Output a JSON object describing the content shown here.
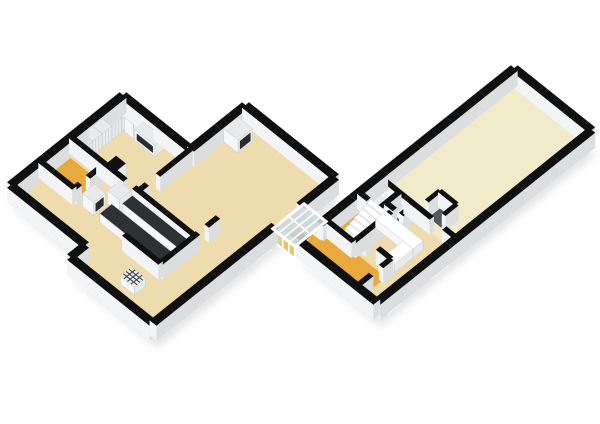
{
  "scene": {
    "type": "isometric-floorplan-3d-render",
    "background": "#FFFFFF",
    "wings": [
      "left-apartment-wing",
      "glass-connector-corridor",
      "right-apartment-wing"
    ]
  },
  "colors": {
    "background": "#FFFFFF",
    "wall_top": "#101010",
    "wall_face_light": "#F3F4F5",
    "wall_face_shade": "#DBDDDF",
    "wall_face_dark": "#C9CCCF",
    "floor_beige": "#EEDBAE",
    "floor_cream": "#F2EBCA",
    "floor_orange": "#E9A93D",
    "floor_dark": "#55585C",
    "window_glass": "#CBD6DD",
    "glass_amber": "#EBC878",
    "frame_white": "#FFFFFF",
    "counter_top_dark": "#2E3134",
    "furniture_top": "#E9EAEC",
    "furniture_face": "#F6F7F8",
    "furniture_stroke": "#C9CCCF",
    "decor_dark": "#2A2C2E",
    "shadow": "rgba(0,0,0,0.10)"
  },
  "floorplan": {
    "projection": {
      "origin": [
        123,
        110
      ],
      "kx": 12.5,
      "ky": 10,
      "wall_height_px": 15
    },
    "floors": [
      {
        "name": "left-wing-floor-beige",
        "color": "floor_beige",
        "pts": [
          [
            0,
            0
          ],
          [
            5.4,
            0
          ],
          [
            5.4,
            -4.4
          ],
          [
            12.6,
            -4.4
          ],
          [
            12.6,
            10.2
          ],
          [
            6.0,
            10.2
          ],
          [
            6.0,
            9.0
          ],
          [
            0,
            9.0
          ]
        ]
      },
      {
        "name": "bathroom-floor-orange",
        "color": "floor_orange",
        "pts": [
          [
            0.3,
            4.5
          ],
          [
            2.55,
            4.5
          ],
          [
            2.55,
            6.45
          ],
          [
            0.3,
            6.45
          ]
        ]
      },
      {
        "name": "right-wing-greatroom-floor-cream",
        "color": "floor_cream",
        "pts": [
          [
            14.3,
            -17
          ],
          [
            20.5,
            -17
          ],
          [
            20.5,
            -6.2
          ],
          [
            14.3,
            -6.2
          ]
        ]
      },
      {
        "name": "right-wing-kitchen-floor-beige",
        "color": "floor_beige",
        "pts": [
          [
            14.3,
            -6.2
          ],
          [
            20.5,
            -6.2
          ],
          [
            20.5,
            0.2
          ],
          [
            14.3,
            0.2
          ]
        ]
      },
      {
        "name": "right-wing-hallway-floor-orange",
        "color": "floor_orange",
        "pts": [
          [
            14.3,
            -6.2
          ],
          [
            15.75,
            -6.2
          ],
          [
            15.75,
            -2.15
          ],
          [
            18.9,
            -2.15
          ],
          [
            18.9,
            0.2
          ],
          [
            14.3,
            0.2
          ]
        ]
      },
      {
        "name": "closet-room-floor-dark",
        "color": "floor_dark",
        "pts": [
          [
            15.9,
            -6.2
          ],
          [
            17.1,
            -6.2
          ],
          [
            17.1,
            -5.15
          ],
          [
            15.9,
            -5.15
          ]
        ]
      },
      {
        "name": "walkin-closet-floor-dark",
        "color": "floor_dark",
        "pts": [
          [
            17.45,
            -7.9
          ],
          [
            18.8,
            -7.9
          ],
          [
            18.8,
            -6.85
          ],
          [
            17.45,
            -6.85
          ]
        ]
      },
      {
        "name": "connector-floor-orange",
        "color": "floor_orange",
        "pts": [
          [
            12.85,
            -1.55
          ],
          [
            14.3,
            -1.55
          ],
          [
            14.3,
            0.45
          ],
          [
            12.85,
            0.45
          ]
        ]
      }
    ],
    "shadows": [
      {
        "name": "left-wing-shadow",
        "pts": [
          [
            0,
            0
          ],
          [
            5.4,
            0
          ],
          [
            5.4,
            -4.4
          ],
          [
            12.6,
            -4.4
          ],
          [
            12.6,
            10.2
          ],
          [
            6.0,
            10.2
          ],
          [
            6.0,
            9.0
          ],
          [
            0,
            9.0
          ]
        ]
      },
      {
        "name": "right-wing-shadow",
        "pts": [
          [
            14.3,
            -17
          ],
          [
            20.5,
            -17
          ],
          [
            20.5,
            0.2
          ],
          [
            14.3,
            0.2
          ]
        ]
      }
    ],
    "walls": [
      [
        "b",
        0.0,
        0.55,
        [
          [
            0,
            9.0
          ]
        ],
        [
          [
            5.1,
            5.9,
            "win"
          ],
          [
            6.7,
            7.5,
            "win"
          ],
          [
            7.7,
            8.5,
            "win"
          ]
        ],
        "left-exterior-wall-nw"
      ],
      [
        "a",
        0.0,
        0.55,
        [
          [
            0,
            5.4
          ]
        ],
        [
          [
            3.5,
            4.3,
            "win"
          ],
          [
            4.75,
            5.25,
            "win"
          ]
        ],
        "left-bedroom-wall-ne"
      ],
      [
        "b",
        5.4,
        0.55,
        [
          [
            -4.4,
            0
          ]
        ],
        [
          [
            -2.1,
            -1.2,
            "win"
          ]
        ],
        "left-living-wall-nw"
      ],
      [
        "a",
        -4.4,
        0.55,
        [
          [
            5.4,
            12.6
          ]
        ],
        [
          [
            6.3,
            7.2,
            "win"
          ],
          [
            8.3,
            9.4,
            "win"
          ],
          [
            10.5,
            11.7,
            "win"
          ]
        ],
        "left-living-wall-ne"
      ],
      [
        "b",
        12.6,
        0.55,
        [
          [
            -4.4,
            -1.55
          ],
          [
            0.45,
            10.2
          ]
        ],
        [
          [
            -4.0,
            -3.1,
            "win"
          ],
          [
            -2.7,
            -1.8,
            "tall"
          ],
          [
            1.1,
            2.1,
            "tall"
          ],
          [
            3.1,
            4.1,
            "win"
          ],
          [
            5.5,
            6.5,
            "win"
          ],
          [
            7.9,
            8.9,
            "win"
          ]
        ],
        "left-exterior-wall-se"
      ],
      [
        "a",
        10.2,
        0.55,
        [
          [
            6.0,
            12.6
          ]
        ],
        [
          [
            6.6,
            7.5,
            "tall"
          ],
          [
            8.4,
            9.5,
            "win"
          ],
          [
            10.5,
            11.5,
            "win"
          ]
        ],
        "left-exterior-wall-south"
      ],
      [
        "b",
        6.0,
        0.55,
        [
          [
            9.0,
            10.2
          ]
        ],
        [],
        "left-exterior-wall-jog"
      ],
      [
        "a",
        9.0,
        0.55,
        [
          [
            0,
            6.0
          ]
        ],
        [
          [
            0.9,
            1.7,
            "win"
          ],
          [
            2.0,
            2.9,
            "win"
          ],
          [
            4.5,
            5.3,
            "win"
          ]
        ],
        "left-exterior-wall-sw"
      ],
      [
        "a",
        4.15,
        0.35,
        [
          [
            0,
            4.35
          ],
          [
            5.05,
            9.9
          ]
        ],
        [],
        "left-wall-bedroom-hall"
      ],
      [
        "b",
        5.4,
        0.35,
        [
          [
            0,
            2.6
          ],
          [
            3.5,
            4.15
          ]
        ],
        [],
        "left-wall-bedroom-living"
      ],
      [
        "b",
        2.7,
        0.35,
        [
          [
            4.15,
            5.5
          ],
          [
            6.15,
            6.6
          ]
        ],
        [],
        "bathroom-wall-east"
      ],
      [
        "a",
        6.6,
        0.35,
        [
          [
            0,
            2.7
          ]
        ],
        [],
        "bathroom-wall-south"
      ],
      [
        "b",
        9.9,
        0.35,
        [
          [
            2.3,
            3.2
          ],
          [
            3.9,
            6.9
          ]
        ],
        [],
        "left-kitchen-wall-east"
      ],
      [
        "a",
        6.9,
        0.35,
        [
          [
            7.0,
            9.9
          ]
        ],
        [],
        "left-utility-wall-north"
      ],
      [
        "b",
        14.3,
        0.55,
        [
          [
            -17.0,
            -1.45
          ],
          [
            -0.25,
            0.2
          ]
        ],
        [
          [
            -16.4,
            -15.0,
            "win"
          ],
          [
            -13.8,
            -12.8,
            "win"
          ],
          [
            -8.9,
            -7.9,
            "win"
          ],
          [
            -5.9,
            -5.1,
            "win"
          ]
        ],
        "right-exterior-wall-nw"
      ],
      [
        "a",
        -17.0,
        0.55,
        [
          [
            14.3,
            20.5
          ]
        ],
        [
          [
            15.3,
            16.3,
            "win"
          ],
          [
            18.8,
            19.8,
            "win"
          ]
        ],
        "right-exterior-wall-ne"
      ],
      [
        "b",
        20.5,
        0.55,
        [
          [
            -17.0,
            0.2
          ]
        ],
        [
          [
            -16.2,
            -15.0,
            "win"
          ],
          [
            -13.0,
            -12.0,
            "win"
          ],
          [
            -7.9,
            -6.8,
            "win"
          ],
          [
            -5.2,
            -4.0,
            "tall"
          ],
          [
            -1.4,
            -0.5,
            "tall"
          ]
        ],
        "right-exterior-wall-se"
      ],
      [
        "a",
        0.2,
        0.55,
        [
          [
            14.3,
            20.5
          ]
        ],
        [
          [
            15.1,
            16.1,
            "tall"
          ],
          [
            17.2,
            18.2,
            "win"
          ],
          [
            19.2,
            20.1,
            "win"
          ]
        ],
        "right-exterior-wall-sw"
      ],
      [
        "a",
        -6.2,
        0.35,
        [
          [
            14.3,
            18.5
          ],
          [
            19.5,
            20.5
          ]
        ],
        [],
        "right-partition-greatroom"
      ],
      [
        "b",
        16.55,
        0.35,
        [
          [
            -4.9,
            -1.9
          ]
        ],
        [],
        "stairwell-wall-east"
      ],
      [
        "a",
        -1.9,
        0.35,
        [
          [
            14.55,
            16.55
          ]
        ],
        [],
        "stairwell-wall-south"
      ],
      [
        "b",
        15.9,
        0.35,
        [
          [
            -6.2,
            -4.6
          ]
        ],
        [],
        "wc-wall-east"
      ],
      [
        "a",
        -4.6,
        0.35,
        [
          [
            14.3,
            15.05
          ]
        ],
        [],
        "wc-wall-south"
      ],
      [
        "b",
        17.1,
        0.35,
        [
          [
            -6.2,
            -5.15
          ]
        ],
        [],
        "closet-room-wall-east"
      ],
      [
        "a",
        -5.15,
        0.35,
        [
          [
            15.9,
            16.6
          ]
        ],
        [],
        "closet-room-wall-south"
      ],
      [
        "b",
        18.9,
        0.35,
        [
          [
            -2.55,
            -1.75
          ],
          [
            -0.95,
            0.2
          ]
        ],
        [],
        "right-hall-wall-east"
      ],
      [
        "a",
        -2.55,
        0.35,
        [
          [
            16.55,
            17.05
          ],
          [
            17.85,
            18.9
          ]
        ],
        [],
        "right-hall-wall-north"
      ],
      [
        "a",
        -7.9,
        0.3,
        [
          [
            17.45,
            18.8
          ]
        ],
        [],
        "walkin-closet-wall-north"
      ],
      [
        "b",
        17.45,
        0.3,
        [
          [
            -7.9,
            -6.85
          ]
        ],
        [],
        "walkin-closet-wall-west"
      ],
      [
        "b",
        18.8,
        0.3,
        [
          [
            -7.9,
            -6.85
          ]
        ],
        [],
        "walkin-closet-wall-east"
      ]
    ],
    "boxes": [
      {
        "a": [
          0.3,
          1.05
        ],
        "b": [
          0.4,
          1.14
        ],
        "h": 14,
        "style": "white",
        "seams": true,
        "name": "wardrobe-closet"
      },
      {
        "a": [
          0.3,
          1.05
        ],
        "b": [
          1.18,
          1.92
        ],
        "h": 14,
        "style": "white",
        "seams": true,
        "name": "wardrobe-closet"
      },
      {
        "a": [
          0.3,
          1.05
        ],
        "b": [
          1.96,
          2.7
        ],
        "h": 14,
        "style": "white",
        "seams": true,
        "name": "wardrobe-closet"
      },
      {
        "a": [
          0.3,
          1.05
        ],
        "b": [
          2.74,
          3.48
        ],
        "h": 14,
        "style": "white",
        "seams": true,
        "name": "wardrobe-closet"
      },
      {
        "a": [
          0.3,
          1.05
        ],
        "b": [
          3.52,
          4.1
        ],
        "h": 14,
        "style": "white",
        "seams": true,
        "name": "wardrobe-closet"
      },
      {
        "a": [
          0.4,
          1.1
        ],
        "b": [
          0.3,
          1.02
        ],
        "h": 14,
        "style": "white",
        "name": "wardrobe-closet"
      },
      {
        "a": [
          1.15,
          1.85
        ],
        "b": [
          0.3,
          1.02
        ],
        "h": 14,
        "style": "white",
        "name": "wardrobe-closet"
      },
      {
        "a": [
          2.0,
          3.6
        ],
        "b": [
          0.3,
          1.05
        ],
        "h": 11,
        "style": "white",
        "front": "v",
        "name": "media-cabinet"
      },
      {
        "a": [
          2.75,
          3.55
        ],
        "b": [
          3.3,
          4.1
        ],
        "h": 15,
        "style": "column",
        "front": "v",
        "name": "chimney-column"
      },
      {
        "a": [
          3.2,
          4.1
        ],
        "b": [
          5.5,
          6.45
        ],
        "h": 13,
        "style": "white",
        "front": "a",
        "name": "washer-dryer"
      },
      {
        "a": [
          4.05,
          5.0
        ],
        "b": [
          4.35,
          5.3
        ],
        "h": 13,
        "style": "white",
        "name": "fridge"
      },
      {
        "a": [
          5.1,
          9.85
        ],
        "b": [
          4.35,
          5.15
        ],
        "h": 9,
        "style": "counter",
        "name": "kitchen-counter"
      },
      {
        "a": [
          4.7,
          9.6
        ],
        "b": [
          5.6,
          6.55
        ],
        "h": 9,
        "style": "counter",
        "name": "kitchen-island"
      },
      {
        "a": [
          8.6,
          9.7
        ],
        "b": [
          7.9,
          8.8
        ],
        "h": 8,
        "style": "grille",
        "name": "floor-grille-unit"
      },
      {
        "a": [
          5.6,
          6.75
        ],
        "b": [
          -3.6,
          -2.45
        ],
        "h": 13,
        "style": "white",
        "front": "a",
        "name": "fireplace"
      },
      {
        "a": [
          16.0,
          19.0
        ],
        "b": [
          -5.0,
          -4.2
        ],
        "h": 9,
        "style": "whitetop",
        "name": "right-kitchen-counter-long"
      },
      {
        "a": [
          18.2,
          19.0
        ],
        "b": [
          -4.2,
          -2.7
        ],
        "h": 9,
        "style": "whitetop",
        "name": "right-kitchen-counter-short"
      },
      {
        "a": [
          14.75,
          15.35
        ],
        "b": [
          -5.9,
          -5.35
        ],
        "h": 5,
        "style": "white",
        "name": "toilet"
      },
      {
        "a": [
          16.1,
          16.9
        ],
        "b": [
          -6.1,
          -5.6
        ],
        "h": 6,
        "style": "white",
        "name": "closet-shelf-box"
      }
    ],
    "stairs": {
      "a": [
        15.05,
        16.35
      ],
      "b_front": -2.05,
      "tread": 0.345,
      "count": 8,
      "h0": 2.2,
      "dh": 1.55,
      "name": "staircase"
    },
    "connector": {
      "glass_walls": [
        {
          "dir": "a",
          "at": -1.55,
          "t": 0.2,
          "a": [
            12.85,
            14.3
          ],
          "tint": "window_glass",
          "name": "connector-glass-wall-ne"
        },
        {
          "dir": "a",
          "at": 0.45,
          "t": 0.2,
          "a": [
            12.85,
            14.3
          ],
          "tint": "glass_amber",
          "name": "connector-glass-wall-sw"
        }
      ],
      "roof": {
        "a": [
          12.68,
          14.45
        ],
        "b": [
          -1.8,
          0.7
        ],
        "name": "connector-glass-roof"
      }
    }
  }
}
